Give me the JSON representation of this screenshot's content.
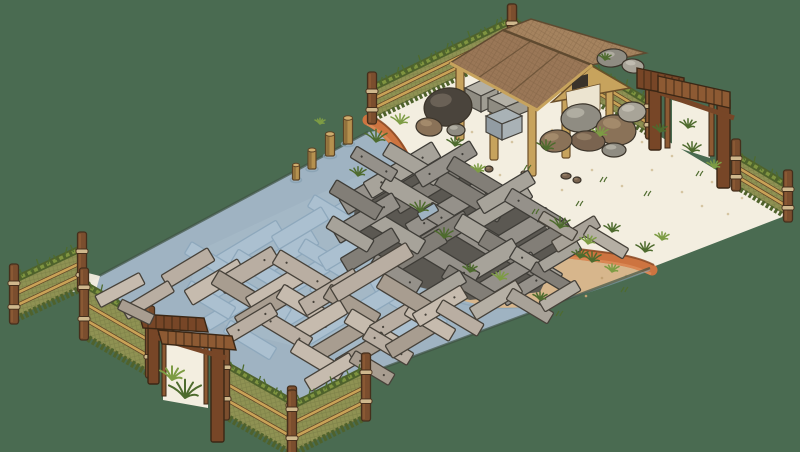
{
  "meta": {
    "title": "Isometric hand-drawn game scene: fenced pond enclosure with sunken and floating planks, sandy shore and a wooden work shelter",
    "viewport": "800x452",
    "visible_text": []
  },
  "colors": {
    "background": "#4a6b51",
    "water": "#9fb3c2",
    "waterDeck": "#a8bcca",
    "waterRim": "#87a0b2",
    "mapEdge": "#3f5243",
    "whiteSand": "#f3eee0",
    "sandSpeckle": "#d5c5a2",
    "tanSand": "#d7b68c",
    "tanSpeckle": "#c2a173",
    "rust": "#cd7440",
    "rustDark": "#8a4a26",
    "rustLight": "#e0925c",
    "fencePanel": "#8f9253",
    "fenceHatch": "#6f7340",
    "fenceGrass": "#7f9440",
    "fenceGrassDark": "#4f622c",
    "rail": "#c9a257",
    "railDark": "#5f4426",
    "post": "#7b4e2e",
    "postLight": "#946038",
    "postStroke": "#452f1c",
    "rope": "#cfb88d",
    "gateWood": "#774627",
    "gateWoodLight": "#8d5a33",
    "gateStroke": "#3b2715",
    "pavPost": "#c7a35d",
    "pavPostStroke": "#6b4f2a",
    "roofFront": "#9a7757",
    "roofBack": "#a5835f",
    "roofEdge": "#5f4a30",
    "roofTrim": "#c7a35d",
    "gableWall": "#ece4d0",
    "windowDark": "#3a332a",
    "plankSub": "#abc0d0",
    "plankSubStroke": "#8ea8bc",
    "plankStroke": "#47423a",
    "plankF": [
      "#b9aea2",
      "#c6bbae",
      "#a89d90"
    ],
    "pileP": [
      "#95918a",
      "#a7a39a",
      "#827e77"
    ],
    "pileUnder": "#5b5852",
    "pileStroke": "#3f3d38",
    "sandPlank": [
      "#a8a298",
      "#b5afa4"
    ],
    "piling": "#b5914f",
    "pilingDark": "#8a6a38",
    "pilingTop": "#d0ae6e",
    "pilingStroke": "#5c4426",
    "rock": [
      "#4a443c",
      "#8f8c82",
      "#8a7258",
      "#a8a498",
      "#7a6450"
    ],
    "rockHi": [
      "#6a6156",
      "#b0ada1",
      "#a38a6b",
      "#c0bcb0",
      "#937d64"
    ],
    "rockStroke": "#3b342a",
    "grassBlade": [
      "#4e6b2e",
      "#7d9c44"
    ],
    "stoneTop": "#b3b0a6",
    "stoneL": "#8f8c82",
    "stoneR": "#a09d93",
    "stoneBlueL": "#929ca3",
    "stoneBlueR": "#a9b2b6",
    "stoneStroke": "#45423c"
  },
  "fences": [
    {
      "name": "fence-nw",
      "a": [
        512,
        50
      ],
      "b": [
        372,
        118
      ],
      "h": 30,
      "front": false
    },
    {
      "name": "fence-ne-left",
      "a": [
        512,
        50
      ],
      "b": [
        650,
        133
      ],
      "h": 30,
      "front": false
    },
    {
      "name": "fence-ne-right",
      "a": [
        736,
        185
      ],
      "b": [
        788,
        216
      ],
      "h": 30,
      "front": false
    },
    {
      "name": "fence-left-stub",
      "a": [
        82,
        286
      ],
      "b": [
        14,
        318
      ],
      "h": 38,
      "front": true
    },
    {
      "name": "fence-sw-upper",
      "a": [
        84,
        334
      ],
      "b": [
        150,
        372
      ],
      "h": 50,
      "front": true
    },
    {
      "name": "fence-sw-lower",
      "a": [
        225,
        414
      ],
      "b": [
        292,
        452
      ],
      "h": 50,
      "front": true
    },
    {
      "name": "fence-se-stub",
      "a": [
        292,
        452
      ],
      "b": [
        366,
        415
      ],
      "h": 46,
      "front": true
    }
  ],
  "pilings": [
    [
      348,
      118,
      26,
      9
    ],
    [
      330,
      134,
      22,
      9
    ],
    [
      312,
      150,
      19,
      8
    ],
    [
      296,
      165,
      15,
      7
    ]
  ],
  "planks": {
    "submerged": [
      [
        250,
        245,
        70,
        16,
        -31
      ],
      [
        285,
        255,
        70,
        16,
        -31
      ],
      [
        262,
        272,
        64,
        15,
        31
      ],
      [
        300,
        280,
        70,
        16,
        -31
      ],
      [
        330,
        262,
        66,
        15,
        31
      ],
      [
        352,
        246,
        70,
        16,
        -31
      ],
      [
        382,
        252,
        64,
        15,
        31
      ],
      [
        402,
        268,
        70,
        16,
        -31
      ],
      [
        428,
        282,
        62,
        15,
        31
      ],
      [
        430,
        300,
        60,
        15,
        -31
      ],
      [
        418,
        312,
        60,
        15,
        31
      ],
      [
        378,
        300,
        70,
        16,
        -31
      ],
      [
        340,
        300,
        62,
        15,
        31
      ],
      [
        300,
        310,
        66,
        16,
        -31
      ],
      [
        262,
        300,
        60,
        15,
        31
      ],
      [
        228,
        282,
        64,
        16,
        -31
      ],
      [
        212,
        262,
        56,
        14,
        31
      ],
      [
        230,
        310,
        56,
        14,
        -31
      ],
      [
        360,
        322,
        60,
        15,
        31
      ],
      [
        398,
        332,
        56,
        14,
        -31
      ],
      [
        320,
        330,
        56,
        15,
        -31
      ],
      [
        360,
        200,
        60,
        15,
        -31
      ],
      [
        390,
        215,
        58,
        14,
        31
      ],
      [
        420,
        230,
        60,
        15,
        -31
      ],
      [
        335,
        215,
        56,
        14,
        31
      ],
      [
        300,
        228,
        58,
        15,
        -31
      ],
      [
        452,
        255,
        56,
        14,
        31
      ],
      [
        250,
        340,
        54,
        14,
        31
      ],
      [
        210,
        300,
        52,
        14,
        31
      ]
    ],
    "pile": [
      [
        380,
        185,
        85,
        18,
        -31,
        0
      ],
      [
        402,
        170,
        80,
        18,
        -31,
        1
      ],
      [
        430,
        186,
        80,
        17,
        -31,
        2
      ],
      [
        416,
        200,
        74,
        17,
        31,
        1
      ],
      [
        446,
        210,
        85,
        18,
        -31,
        0
      ],
      [
        470,
        196,
        74,
        17,
        31,
        2
      ],
      [
        494,
        210,
        80,
        18,
        -31,
        1
      ],
      [
        462,
        230,
        80,
        17,
        31,
        0
      ],
      [
        432,
        240,
        84,
        18,
        -31,
        2
      ],
      [
        490,
        240,
        74,
        17,
        31,
        1
      ],
      [
        520,
        232,
        70,
        16,
        -31,
        0
      ],
      [
        514,
        256,
        74,
        17,
        31,
        2
      ],
      [
        482,
        266,
        80,
        17,
        -31,
        1
      ],
      [
        446,
        262,
        70,
        16,
        31,
        0
      ],
      [
        416,
        252,
        64,
        16,
        -31,
        2
      ],
      [
        396,
        232,
        60,
        16,
        31,
        1
      ],
      [
        366,
        218,
        70,
        17,
        -31,
        0
      ],
      [
        356,
        200,
        54,
        15,
        31,
        2
      ],
      [
        412,
        164,
        60,
        15,
        31,
        1
      ],
      [
        446,
        164,
        64,
        16,
        -31,
        0
      ],
      [
        476,
        178,
        60,
        15,
        31,
        2
      ],
      [
        506,
        192,
        60,
        15,
        -31,
        1
      ],
      [
        534,
        210,
        60,
        15,
        31,
        0
      ],
      [
        544,
        240,
        58,
        15,
        -31,
        2
      ],
      [
        506,
        276,
        68,
        16,
        -31,
        0
      ],
      [
        536,
        266,
        54,
        14,
        31,
        1
      ],
      [
        470,
        286,
        58,
        15,
        31,
        2
      ],
      [
        440,
        290,
        54,
        14,
        -31,
        1
      ],
      [
        396,
        274,
        54,
        15,
        31,
        0
      ],
      [
        370,
        250,
        60,
        16,
        -31,
        2
      ],
      [
        350,
        234,
        48,
        14,
        31,
        1
      ],
      [
        524,
        288,
        48,
        13,
        -31,
        0
      ],
      [
        552,
        278,
        44,
        12,
        31,
        2
      ],
      [
        560,
        256,
        44,
        12,
        -31,
        1
      ],
      [
        374,
        164,
        48,
        13,
        31,
        0
      ]
    ],
    "hole": [
      [
        428,
        212,
        20,
        9,
        -31
      ]
    ],
    "floating": [
      [
        215,
        282,
        62,
        17,
        -31,
        1
      ],
      [
        248,
        270,
        64,
        17,
        -31,
        0
      ],
      [
        240,
        292,
        58,
        16,
        31,
        2
      ],
      [
        278,
        288,
        66,
        17,
        -31,
        1
      ],
      [
        302,
        272,
        60,
        16,
        31,
        0
      ],
      [
        265,
        308,
        62,
        16,
        -31,
        2
      ],
      [
        305,
        306,
        58,
        16,
        31,
        1
      ],
      [
        330,
        292,
        64,
        17,
        -31,
        0
      ],
      [
        352,
        306,
        58,
        16,
        31,
        2
      ],
      [
        318,
        322,
        60,
        16,
        -31,
        1
      ],
      [
        285,
        330,
        56,
        15,
        31,
        0
      ],
      [
        340,
        340,
        62,
        16,
        -31,
        2
      ],
      [
        372,
        330,
        56,
        16,
        31,
        1
      ],
      [
        398,
        318,
        58,
        16,
        -31,
        0
      ],
      [
        362,
        352,
        54,
        15,
        -31,
        2
      ],
      [
        318,
        360,
        56,
        15,
        31,
        1
      ],
      [
        388,
        346,
        52,
        14,
        31,
        0
      ],
      [
        412,
        338,
        54,
        15,
        -31,
        2
      ],
      [
        430,
        322,
        52,
        14,
        31,
        1
      ],
      [
        252,
        322,
        52,
        14,
        -31,
        0
      ],
      [
        372,
        272,
        88,
        16,
        -31,
        0
      ],
      [
        406,
        296,
        60,
        16,
        31,
        2
      ],
      [
        440,
        306,
        56,
        15,
        -31,
        1
      ],
      [
        460,
        318,
        48,
        14,
        31,
        0
      ],
      [
        330,
        372,
        52,
        14,
        -31,
        1
      ],
      [
        372,
        368,
        46,
        13,
        31,
        2
      ],
      [
        188,
        268,
        54,
        15,
        -31,
        0
      ]
    ],
    "on_sand": [
      [
        576,
        234,
        50,
        13,
        -31,
        0
      ],
      [
        606,
        242,
        46,
        12,
        31,
        1
      ],
      [
        558,
        226,
        40,
        11,
        31,
        0
      ],
      [
        496,
        300,
        54,
        14,
        -31,
        1
      ],
      [
        530,
        306,
        48,
        13,
        31,
        0
      ],
      [
        560,
        296,
        42,
        12,
        -31,
        1
      ]
    ],
    "on_grass": [
      [
        120,
        290,
        50,
        13,
        -28,
        1
      ],
      [
        148,
        300,
        54,
        13,
        -31,
        0
      ],
      [
        136,
        312,
        36,
        11,
        26,
        2
      ]
    ]
  },
  "rocks": [
    [
      448,
      107,
      24,
      19,
      -8,
      0
    ],
    [
      429,
      127,
      13,
      9,
      6,
      2
    ],
    [
      456,
      130,
      9,
      6,
      0,
      1
    ],
    [
      581,
      118,
      20,
      14,
      -6,
      1
    ],
    [
      616,
      130,
      20,
      15,
      8,
      2
    ],
    [
      632,
      112,
      14,
      10,
      -4,
      3
    ],
    [
      588,
      141,
      17,
      10,
      4,
      4
    ],
    [
      556,
      141,
      16,
      11,
      -6,
      2
    ],
    [
      614,
      150,
      12,
      7,
      0,
      1
    ],
    [
      612,
      58,
      15,
      9,
      -5,
      1
    ],
    [
      633,
      66,
      11,
      7,
      6,
      3
    ],
    [
      566,
      176,
      5,
      3,
      0,
      4
    ],
    [
      577,
      180,
      4,
      3,
      0,
      4
    ],
    [
      489,
      169,
      4,
      3,
      0,
      4
    ],
    [
      524,
      173,
      3,
      2,
      0,
      4
    ]
  ],
  "grass": [
    [
      376,
      142,
      11,
      0
    ],
    [
      400,
      124,
      9,
      1
    ],
    [
      455,
      146,
      8,
      0
    ],
    [
      546,
      150,
      9,
      0
    ],
    [
      600,
      136,
      8,
      1
    ],
    [
      660,
      132,
      7,
      0
    ],
    [
      692,
      152,
      9,
      0
    ],
    [
      714,
      168,
      7,
      1
    ],
    [
      420,
      212,
      10,
      0
    ],
    [
      444,
      238,
      9,
      0
    ],
    [
      478,
      172,
      7,
      1
    ],
    [
      358,
      176,
      8,
      0
    ],
    [
      560,
      228,
      10,
      0
    ],
    [
      588,
      244,
      8,
      1
    ],
    [
      612,
      232,
      8,
      0
    ],
    [
      645,
      252,
      9,
      0
    ],
    [
      662,
      240,
      7,
      1
    ],
    [
      592,
      262,
      9,
      0
    ],
    [
      612,
      272,
      7,
      1
    ],
    [
      500,
      280,
      8,
      1
    ],
    [
      470,
      272,
      7,
      0
    ],
    [
      540,
      300,
      7,
      0
    ],
    [
      580,
      258,
      8,
      0
    ],
    [
      70,
      278,
      6,
      0
    ],
    [
      320,
      124,
      5,
      1
    ],
    [
      605,
      60,
      6,
      0
    ]
  ],
  "grass_front": [
    [
      185,
      398,
      16,
      0
    ],
    [
      172,
      380,
      12,
      1
    ],
    [
      688,
      128,
      8,
      0
    ]
  ],
  "weeds": [
    [
      528,
      170
    ],
    [
      604,
      182
    ],
    [
      648,
      196
    ],
    [
      700,
      176
    ],
    [
      580,
      206
    ],
    [
      536,
      214
    ],
    [
      625,
      292
    ],
    [
      560,
      316
    ]
  ],
  "speckles": {
    "white": [
      [
        430,
        150
      ],
      [
        462,
        162
      ],
      [
        500,
        175
      ],
      [
        532,
        160
      ],
      [
        562,
        190
      ],
      [
        592,
        170
      ],
      [
        622,
        186
      ],
      [
        652,
        170
      ],
      [
        682,
        192
      ],
      [
        712,
        182
      ],
      [
        742,
        198
      ],
      [
        472,
        132
      ],
      [
        512,
        142
      ],
      [
        552,
        130
      ],
      [
        642,
        142
      ],
      [
        602,
        120
      ],
      [
        672,
        156
      ],
      [
        702,
        206
      ],
      [
        728,
        214
      ]
    ],
    "tan": [
      [
        470,
        290
      ],
      [
        522,
        296
      ],
      [
        562,
        286
      ],
      [
        602,
        278
      ],
      [
        452,
        310
      ],
      [
        432,
        252
      ],
      [
        416,
        236
      ],
      [
        492,
        306
      ],
      [
        544,
        306
      ],
      [
        586,
        296
      ],
      [
        626,
        276
      ]
    ]
  }
}
